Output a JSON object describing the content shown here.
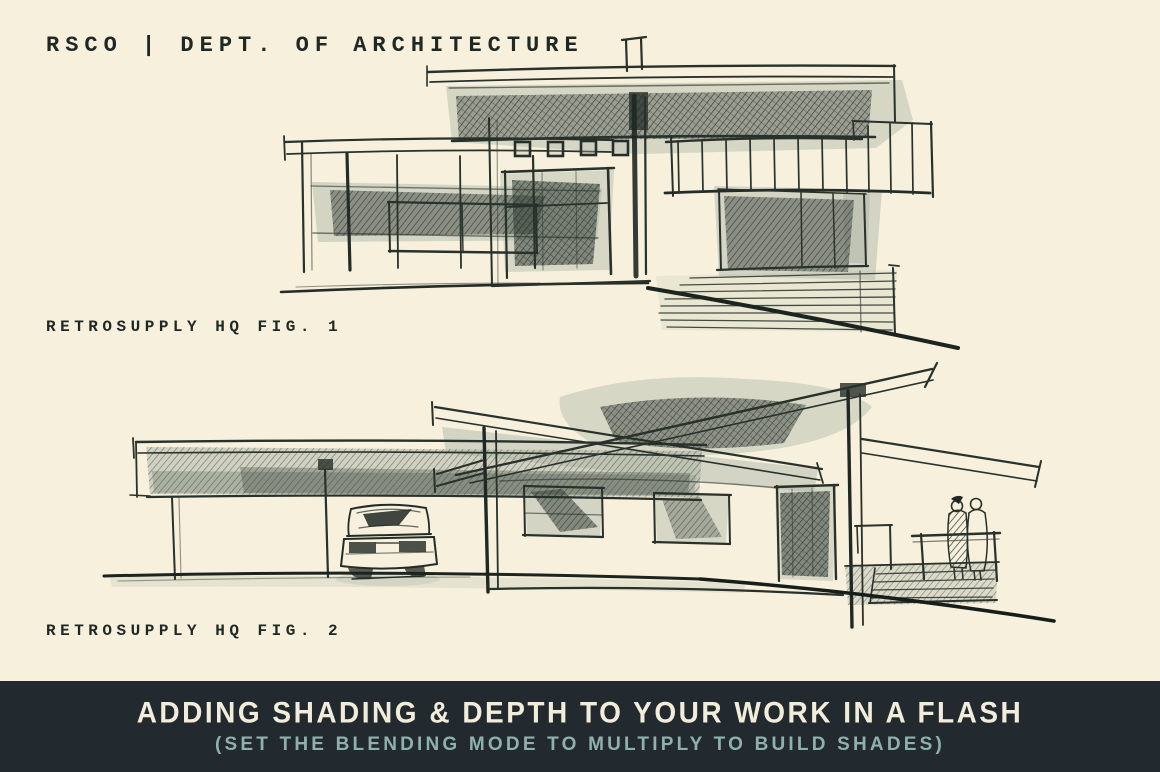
{
  "canvas": {
    "width": 1160,
    "height": 772,
    "background": "#f6f0dc",
    "ink": "#2a322c",
    "wash": "#a9b2a4"
  },
  "header": {
    "title": "RSCO | DEPT. OF ARCHITECTURE"
  },
  "figures": [
    {
      "label": "RETROSUPPLY HQ FIG. 1",
      "alt": "ink-and-wash elevation sketch of a flat-roof modern house with chimney, four small windows, shaded entry, balcony railing and sloping ground"
    },
    {
      "label": "RETROSUPPLY HQ FIG. 2",
      "alt": "ink-and-wash sketch of a butterfly-roof mid-century house with carport, parked car, shaded door and two figures on a railed deck"
    }
  ],
  "banner": {
    "background": "#232a2f",
    "headline": "ADDING SHADING & DEPTH TO YOUR WORK IN A FLASH",
    "headline_color": "#f2edda",
    "subline": "(SET THE BLENDING MODE TO MULTIPLY TO BUILD SHADES)",
    "subline_color": "#8fb1ab"
  }
}
